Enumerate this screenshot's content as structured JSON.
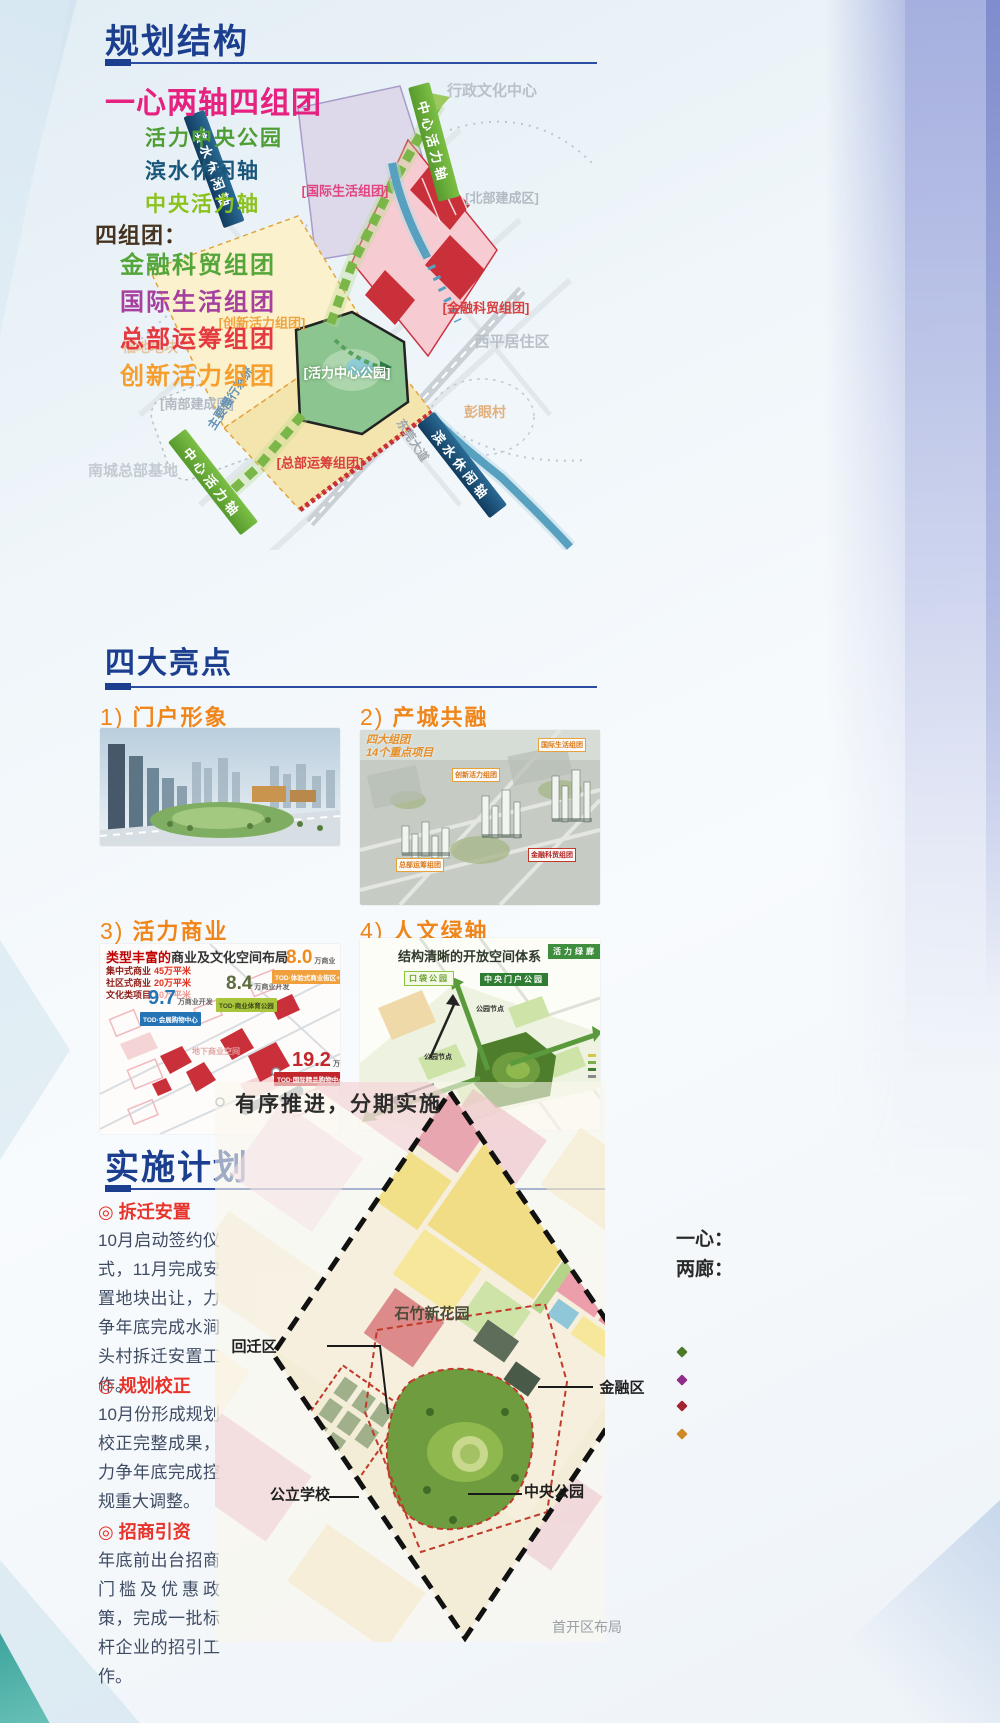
{
  "colors": {
    "heading_navy": "#1b3e8e",
    "subtitle_pink": "#e6217f",
    "axis_park_green": "#4f9e35",
    "axis_water_navy": "#19567a",
    "axis_central_green": "#8cc21e",
    "group_finance_green": "#54a53a",
    "group_intl_purple": "#a6409f",
    "group_hq_red": "#e5383f",
    "group_innov_orange": "#f59e2b",
    "highlight_orange": "#f08519",
    "imp_red": "#e8332a",
    "body_text": "#3f4c63"
  },
  "planning": {
    "heading": "规划结构",
    "subtitle": "一心两轴四组团",
    "axes": [
      {
        "label": "活力中央公园",
        "color": "#4f9e35"
      },
      {
        "label": "滨水休闲轴",
        "color": "#19567a"
      },
      {
        "label": "中央活力轴",
        "color": "#8cc21e"
      }
    ],
    "groups_label": "四组团：",
    "groups": [
      {
        "label": "金融科贸组团",
        "color": "#54a53a"
      },
      {
        "label": "国际生活组团",
        "color": "#a6409f"
      },
      {
        "label": "总部运筹组团",
        "color": "#e5383f"
      },
      {
        "label": "创新活力组团",
        "color": "#f59e2b"
      }
    ],
    "map": {
      "admin_center": "行政文化中心",
      "north_built": "[北部建成区]",
      "intl": "[国际生活组团]",
      "finance": "[金融科贸组团]",
      "xiping": "西平居住区",
      "innovation": "[创新活力组团]",
      "central_park": "[活力中心公园]",
      "fudi": "福地地块",
      "south_built": "[南部建成区]",
      "slow_traffic": "主要慢行系统",
      "dongguan_ave": "东莞大道",
      "pengyan": "彭眼村",
      "hq_base": "南城总部基地",
      "hq_group": "[总部运筹组团]",
      "banner_waterfront": "滨水休闲轴",
      "banner_central": "中心活力轴"
    }
  },
  "highlights": {
    "heading": "四大亮点",
    "items": [
      {
        "num": "1)",
        "title": "门户形象"
      },
      {
        "num": "2)",
        "title": "产城共融",
        "note1": "四大组团",
        "note2": "14个重点项目",
        "chips": [
          {
            "label": "创新活力组团"
          },
          {
            "label": "国际生活组团"
          },
          {
            "label": "总部运筹组团"
          },
          {
            "label": "金融科贸组团"
          }
        ]
      },
      {
        "num": "3)",
        "title": "活力商业",
        "subtitle_strong": "类型丰富的",
        "subtitle": "商业及文化空间布局",
        "stats": [
          {
            "label": "集中式商业",
            "value": "45万平米"
          },
          {
            "label": "社区式商业",
            "value": "20万平米"
          },
          {
            "label": "文化类项目",
            "value": "10万平米"
          }
        ],
        "markers": [
          {
            "value": "9.7",
            "unit": "万商业开发",
            "chip": "TOD·会展购物中心",
            "color": "#2473b5"
          },
          {
            "value": "8.4",
            "unit": "万商业开发",
            "chip": "TOD·商业体育公园",
            "color": "#5c6b3c"
          },
          {
            "value": "8.0",
            "unit": "万商业开发",
            "chip": "TOD·体验式商业街区+MALL",
            "color": "#f08c1e"
          },
          {
            "value": "19.2",
            "unit": "万商业开发",
            "chip": "TOD·国际精品购物中心",
            "color": "#c1272d"
          }
        ],
        "faint_label": "地下商业空间"
      },
      {
        "num": "4)",
        "title": "人文绿轴",
        "subtitle": "结构清晰的开放空间体系",
        "banner": "活力绿廊",
        "chips": [
          {
            "label": "口袋公园"
          },
          {
            "label": "中央门户公园"
          }
        ],
        "node_label": "公园节点"
      }
    ]
  },
  "implementation": {
    "heading": "实施计划",
    "map_title": "有序推进，分期实施",
    "bullet": "◎",
    "blocks": [
      {
        "title": "拆迁安置",
        "body": "10月启动签约仪式，11月完成安置地块出让，力争年底完成水涧头村拆迁安置工作。"
      },
      {
        "title": "规划校正",
        "body": "10月份形成规划校正完整成果，力争年底完成控规重大调整。"
      },
      {
        "title": "招商引资",
        "body": "年底前出台招商门槛及优惠政策，完成一批标杆企业的招引工作。"
      }
    ],
    "map_labels": {
      "garden": "石竹新花园",
      "relocation": "回迁区",
      "finance_zone": "金融区",
      "school": "公立学校",
      "central_park": "中央公园",
      "caption": "首开区布局"
    },
    "side": {
      "one_heart": "一心：",
      "two_corridors": "两廊：",
      "diamond_colors": [
        "#4c7a28",
        "#8e2d88",
        "#a22430",
        "#cf8a25"
      ]
    }
  }
}
